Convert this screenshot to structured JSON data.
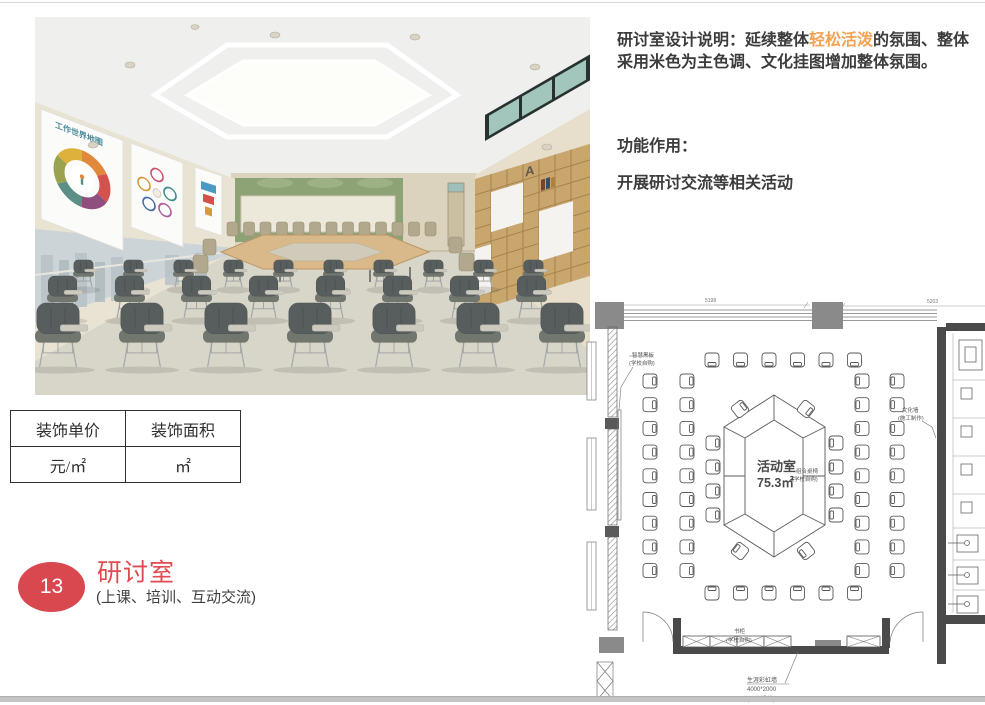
{
  "description": {
    "line1_prefix": "研讨室设计说明：延续整体",
    "highlight": "轻松活泼",
    "highlight_color": "#f2a254",
    "line1_suffix": "的氛围、整体采用米色为主色调、文化挂图增加整体氛围。",
    "function_label": "功能作用：",
    "function_text": "开展研讨交流等相关活动"
  },
  "price_table": {
    "headers": [
      "装饰单价",
      "装饰面积"
    ],
    "values": [
      "元/㎡",
      "㎡"
    ]
  },
  "section": {
    "number": "13",
    "title": "研讨室",
    "subtitle": "(上课、培训、互动交流)",
    "badge_color": "#d9474f"
  },
  "photo": {
    "poster_title": "工作世界地图",
    "shelf_letter": "A"
  },
  "floorplan": {
    "room_label": "活动室",
    "room_area": "75.3㎡",
    "furniture_note_1": "组合桌椅",
    "furniture_note_2": "(学校自购)",
    "dim_left": "5198",
    "dim_right": "5203",
    "ann_blackboard_1": "智慧黑板",
    "ann_blackboard_2": "(学校自购)",
    "ann_culture_1": "文化墙",
    "ann_culture_2": "(施工制作)",
    "ann_bookcase_1": "书柜",
    "ann_bookcase_2": "(学校自购)",
    "ann_rainbow_1": "生涯彩虹墙",
    "ann_rainbow_2": "4000*2000",
    "ann_rainbow_3": "(深化设计)"
  }
}
